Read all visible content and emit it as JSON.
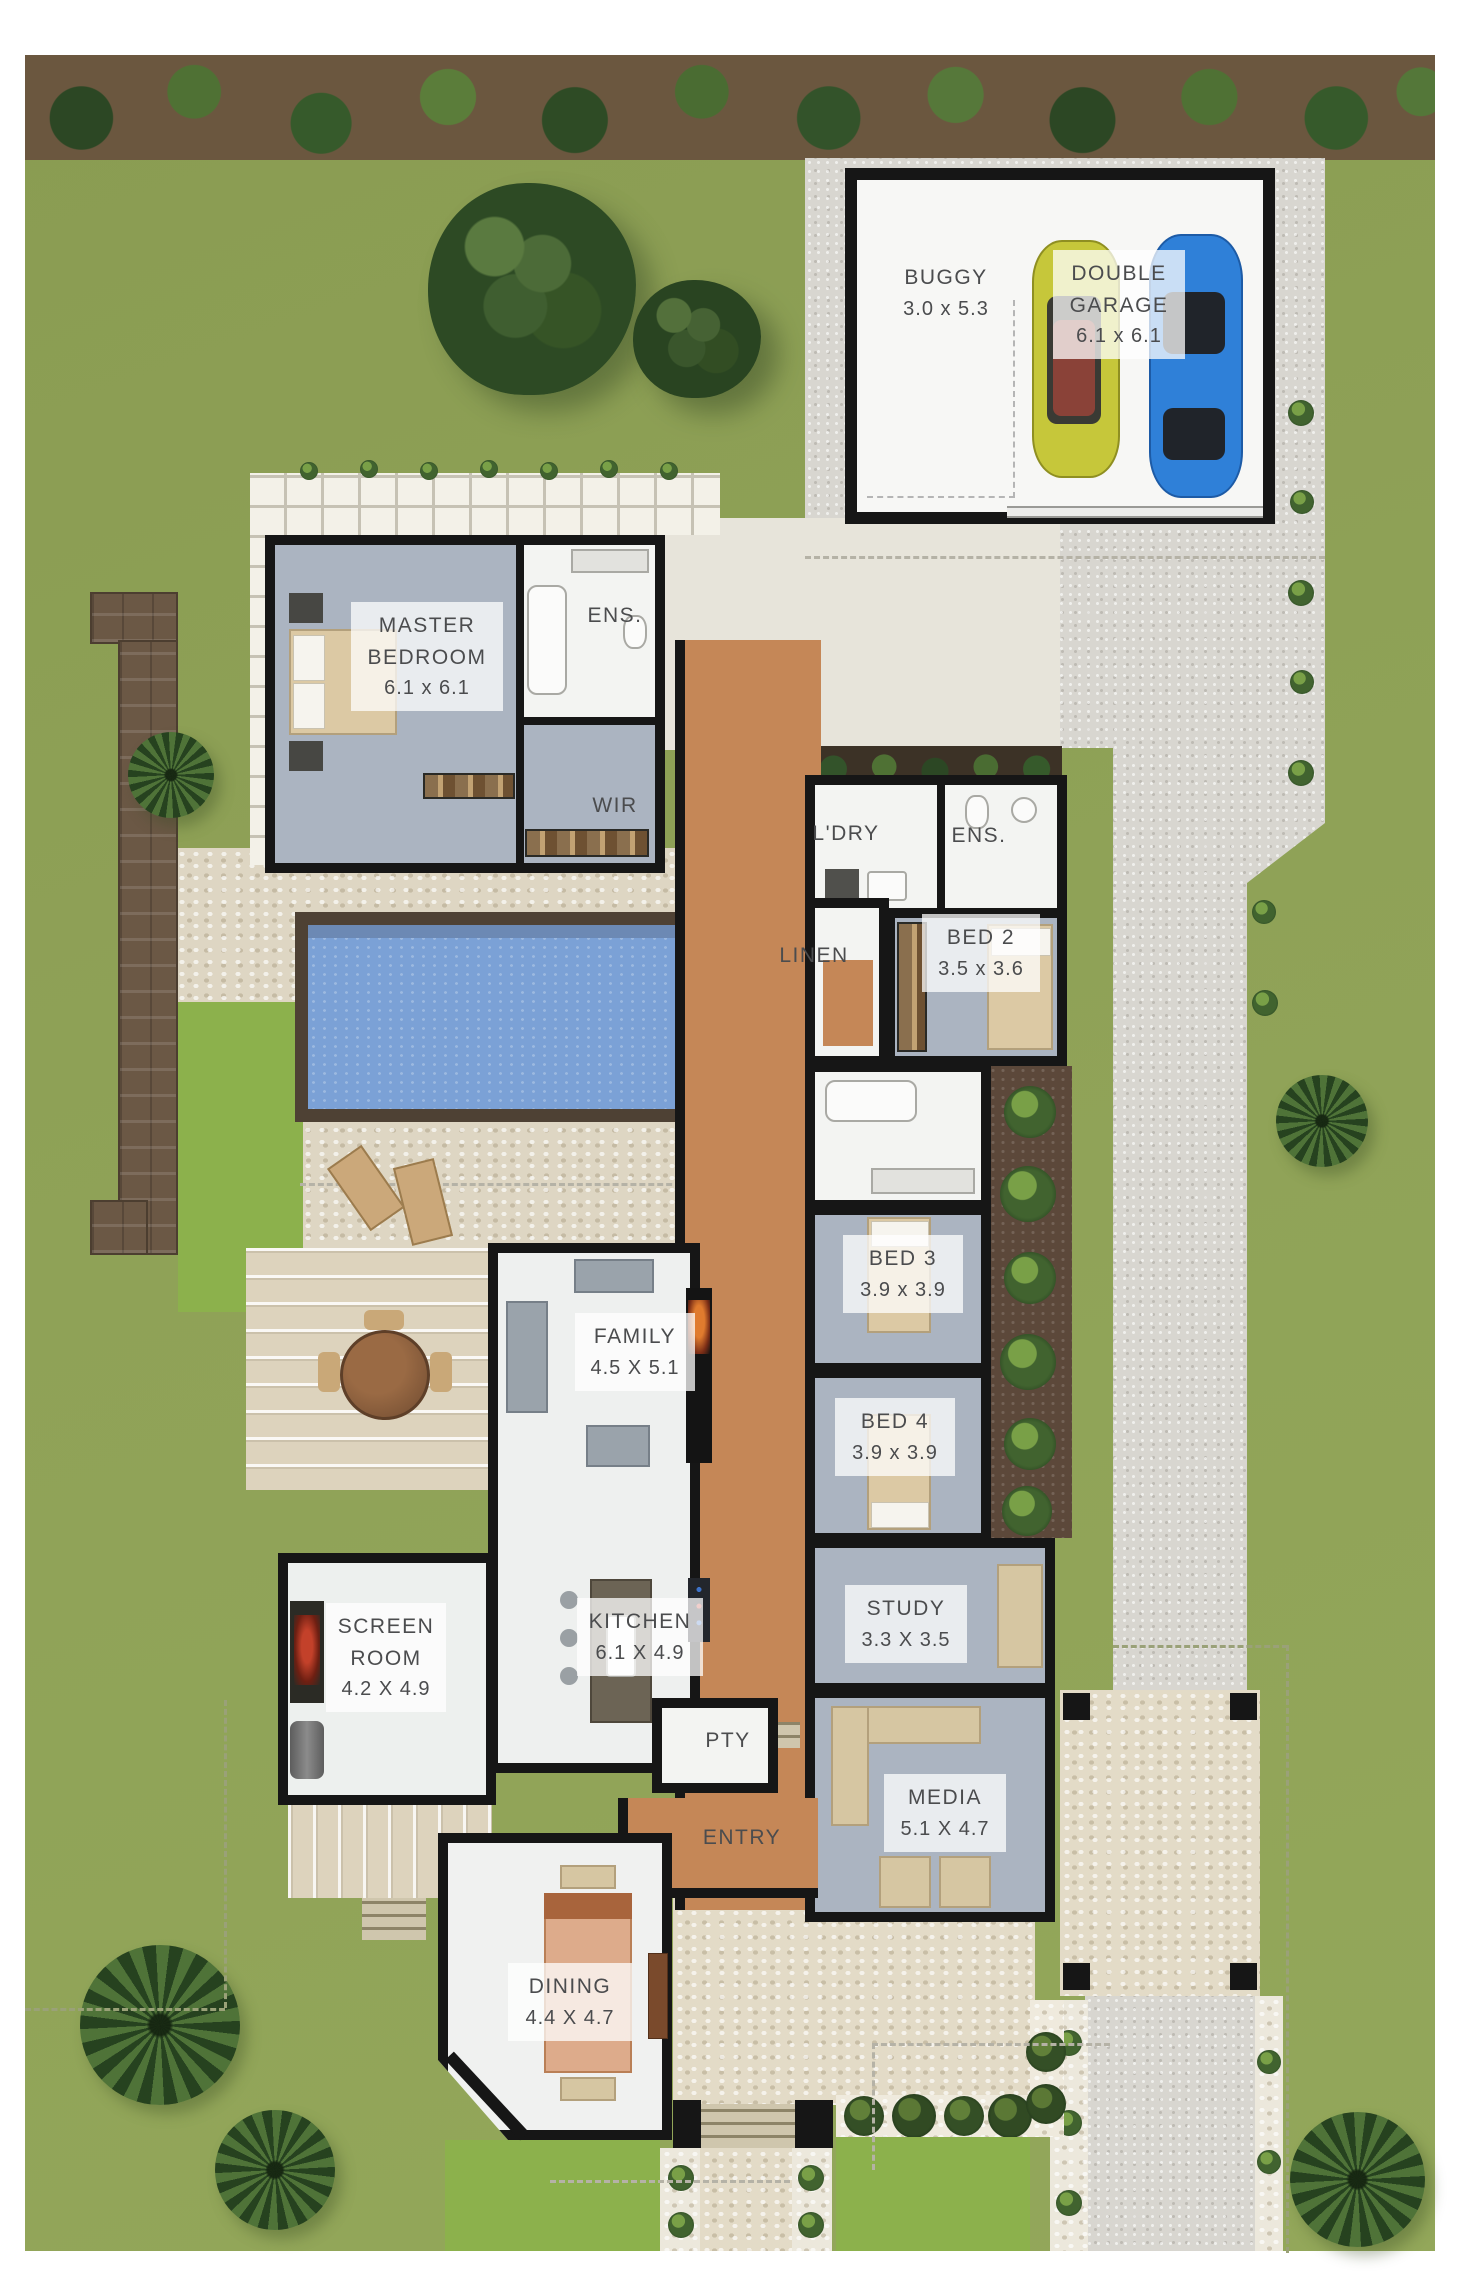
{
  "plan": {
    "type": "residential-floor-plan",
    "rooms": [
      {
        "id": "buggy",
        "name": "BUGGY",
        "dims": "3.0 x 5.3"
      },
      {
        "id": "double-garage",
        "name": "DOUBLE GARAGE",
        "dims": "6.1 x 6.1"
      },
      {
        "id": "master-bedroom",
        "name": "MASTER BEDROOM",
        "dims": "6.1 x 6.1"
      },
      {
        "id": "ensuite-master",
        "name": "ENS."
      },
      {
        "id": "walk-in-robe",
        "name": "WIR"
      },
      {
        "id": "laundry",
        "name": "L'DRY"
      },
      {
        "id": "ensuite-bed2",
        "name": "ENS."
      },
      {
        "id": "linen",
        "name": "LINEN"
      },
      {
        "id": "bed2",
        "name": "BED 2",
        "dims": "3.5 x 3.6"
      },
      {
        "id": "bed3",
        "name": "BED 3",
        "dims": "3.9 x 3.9"
      },
      {
        "id": "bed4",
        "name": "BED 4",
        "dims": "3.9 x 3.9"
      },
      {
        "id": "family",
        "name": "FAMILY",
        "dims": "4.5 X 5.1"
      },
      {
        "id": "kitchen",
        "name": "KITCHEN",
        "dims": "6.1 X 4.9"
      },
      {
        "id": "study",
        "name": "STUDY",
        "dims": "3.3 X 3.5"
      },
      {
        "id": "screen-room",
        "name": "SCREEN ROOM",
        "dims": "4.2 X 4.9"
      },
      {
        "id": "pantry",
        "name": "PTY"
      },
      {
        "id": "media",
        "name": "MEDIA",
        "dims": "5.1 X 4.7"
      },
      {
        "id": "entry",
        "name": "ENTRY"
      },
      {
        "id": "dining",
        "name": "DINING",
        "dims": "4.4 X 4.7"
      }
    ],
    "colors": {
      "grass": "#8c9e55",
      "grass_bright": "#8cb14c",
      "driveway": "#d8d6d0",
      "pool_paving": "#ded6c3",
      "porch_pebble": "#e3dbc7",
      "hall_floor": "#c58757",
      "pool_water": "#7ba1d6",
      "pool_edge": "#4e4134",
      "wall": "#161616",
      "room_grey": "#abb4c1",
      "room_white": "#f3f4f2",
      "label_text": "#4b4c4e",
      "hedge_soil": "#6b573f",
      "tree_green": "#2d4a24",
      "car_yellow": "#c6c73a",
      "car_blue": "#2f80d8",
      "timber": "#dcc9a4",
      "mulch": "#5c483a"
    }
  }
}
